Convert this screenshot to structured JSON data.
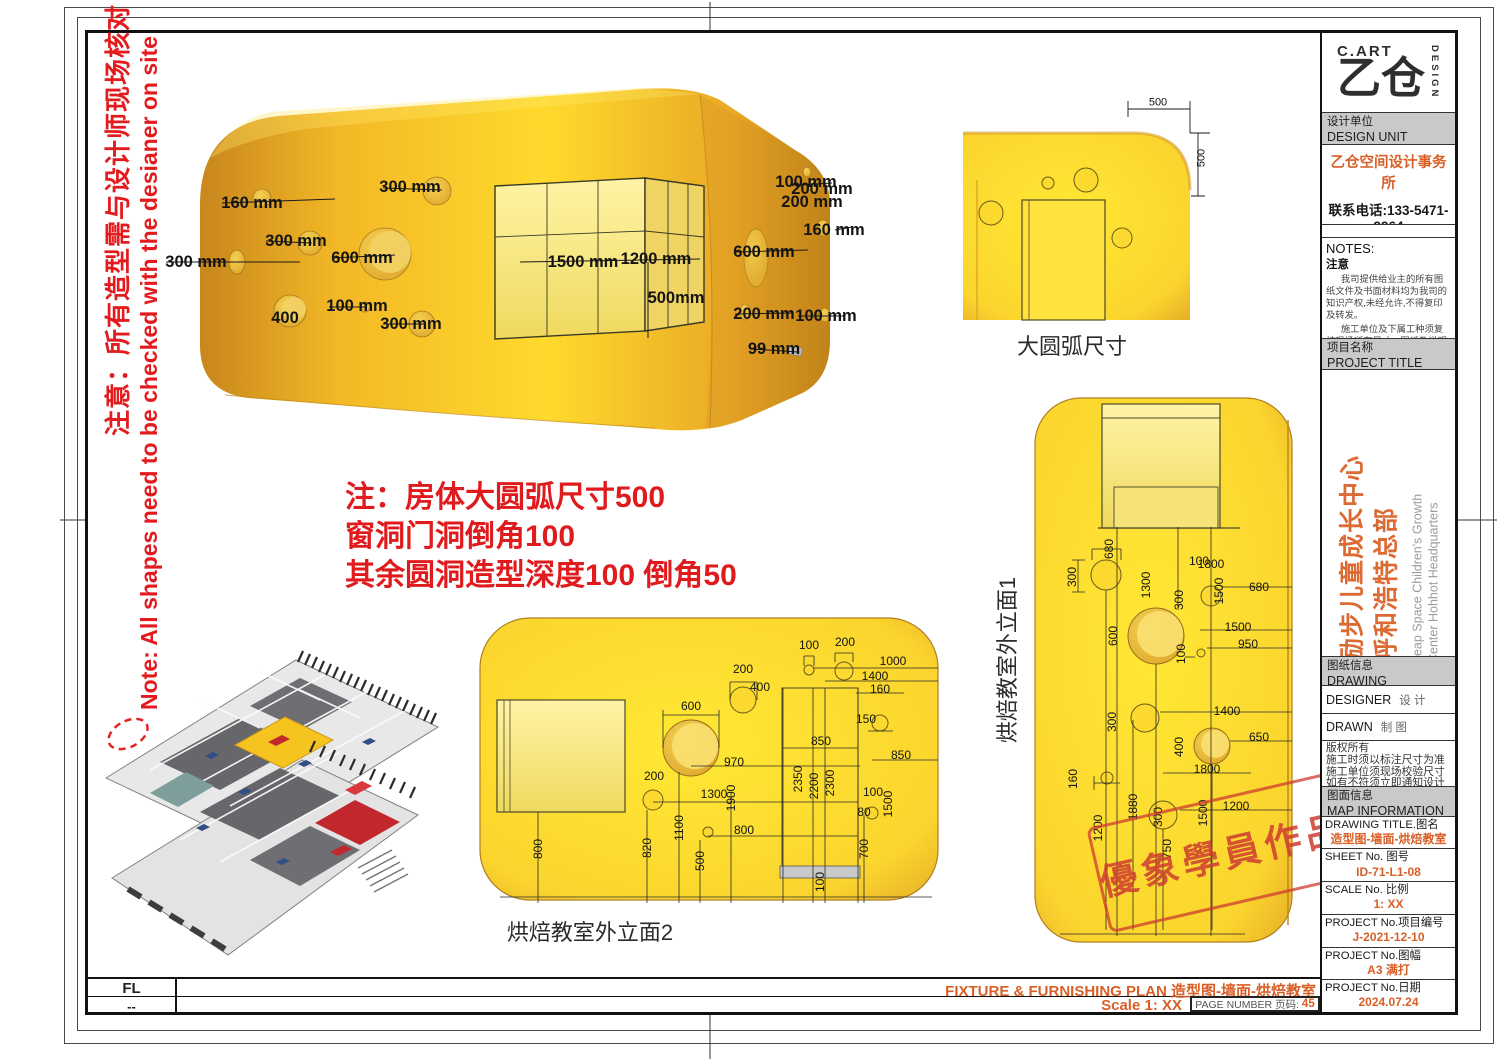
{
  "colors": {
    "accent_orange": "#D95F26",
    "note_red": "#E01B1E",
    "stamp_red": "#CE3C30",
    "panel_yellow": "#FFE02E"
  },
  "left_note": {
    "zh": "注意：所有造型需与设计师现场核对",
    "en": "Note: All shapes need to be checked with the desianer on site"
  },
  "center_note": {
    "line1": "注：房体大圆弧尺寸500",
    "line2": "窗洞门洞倒角100",
    "line3": "其余圆洞造型深度100 倒角50"
  },
  "views": {
    "main3d": {
      "dims": [
        {
          "t": "160 mm",
          "x": 252,
          "y": 203
        },
        {
          "t": "300 mm",
          "x": 410,
          "y": 187
        },
        {
          "t": "300 mm",
          "x": 296,
          "y": 241
        },
        {
          "t": "300 mm",
          "x": 196,
          "y": 262
        },
        {
          "t": "600 mm",
          "x": 362,
          "y": 258
        },
        {
          "t": "400",
          "x": 285,
          "y": 318
        },
        {
          "t": "100 mm",
          "x": 357,
          "y": 306
        },
        {
          "t": "300 mm",
          "x": 411,
          "y": 324
        },
        {
          "t": "1500 mm",
          "x": 583,
          "y": 262
        },
        {
          "t": "1200 mm",
          "x": 656,
          "y": 259
        },
        {
          "t": "500mm",
          "x": 676,
          "y": 298
        },
        {
          "t": "100 mm",
          "x": 806,
          "y": 182
        },
        {
          "t": "200 mm",
          "x": 822,
          "y": 189
        },
        {
          "t": "200 mm",
          "x": 812,
          "y": 202
        },
        {
          "t": "160 mm",
          "x": 834,
          "y": 230
        },
        {
          "t": "600 mm",
          "x": 764,
          "y": 252
        },
        {
          "t": "200 mm",
          "x": 764,
          "y": 314
        },
        {
          "t": "100 mm",
          "x": 826,
          "y": 316
        },
        {
          "t": "99 mm",
          "x": 774,
          "y": 349
        }
      ]
    },
    "corner_detail": {
      "caption": "大圆弧尺寸",
      "dims": [
        {
          "t": "500",
          "x": 1158,
          "y": 103
        },
        {
          "t": "500",
          "x": 1202,
          "y": 158,
          "r": -90
        }
      ]
    },
    "elevation2": {
      "caption": "烘焙教室外立面2",
      "dims": [
        {
          "t": "100",
          "x": 809,
          "y": 645
        },
        {
          "t": "200",
          "x": 845,
          "y": 642
        },
        {
          "t": "1000",
          "x": 893,
          "y": 661
        },
        {
          "t": "1400",
          "x": 875,
          "y": 676
        },
        {
          "t": "160",
          "x": 880,
          "y": 689
        },
        {
          "t": "200",
          "x": 743,
          "y": 669
        },
        {
          "t": "400",
          "x": 760,
          "y": 687
        },
        {
          "t": "600",
          "x": 691,
          "y": 706
        },
        {
          "t": "150",
          "x": 866,
          "y": 719
        },
        {
          "t": "850",
          "x": 821,
          "y": 741
        },
        {
          "t": "850",
          "x": 901,
          "y": 755
        },
        {
          "t": "970",
          "x": 734,
          "y": 762
        },
        {
          "t": "2350",
          "x": 798,
          "y": 779,
          "r": -90
        },
        {
          "t": "2200",
          "x": 814,
          "y": 786,
          "r": -90
        },
        {
          "t": "2300",
          "x": 830,
          "y": 783,
          "r": -90
        },
        {
          "t": "200",
          "x": 654,
          "y": 776
        },
        {
          "t": "1300",
          "x": 714,
          "y": 794
        },
        {
          "t": "1900",
          "x": 731,
          "y": 798,
          "r": -90
        },
        {
          "t": "100",
          "x": 873,
          "y": 792
        },
        {
          "t": "1500",
          "x": 888,
          "y": 804,
          "r": -90
        },
        {
          "t": "80",
          "x": 864,
          "y": 812
        },
        {
          "t": "1100",
          "x": 679,
          "y": 828,
          "r": -90
        },
        {
          "t": "800",
          "x": 744,
          "y": 830
        },
        {
          "t": "800",
          "x": 538,
          "y": 849,
          "r": -90
        },
        {
          "t": "820",
          "x": 647,
          "y": 848,
          "r": -90
        },
        {
          "t": "500",
          "x": 700,
          "y": 861,
          "r": -90
        },
        {
          "t": "700",
          "x": 864,
          "y": 849,
          "r": -90
        },
        {
          "t": "100",
          "x": 820,
          "y": 882,
          "r": -90
        }
      ]
    },
    "elevation1": {
      "caption": "烘焙教室外立面1",
      "dims": [
        {
          "t": "680",
          "x": 1109,
          "y": 549,
          "r": -90
        },
        {
          "t": "300",
          "x": 1072,
          "y": 577,
          "r": -90
        },
        {
          "t": "1300",
          "x": 1146,
          "y": 585,
          "r": -90
        },
        {
          "t": "100",
          "x": 1199,
          "y": 561
        },
        {
          "t": "1800",
          "x": 1211,
          "y": 564
        },
        {
          "t": "1500",
          "x": 1219,
          "y": 591,
          "r": -90
        },
        {
          "t": "680",
          "x": 1259,
          "y": 587
        },
        {
          "t": "300",
          "x": 1179,
          "y": 600,
          "r": -90
        },
        {
          "t": "600",
          "x": 1113,
          "y": 636,
          "r": -90
        },
        {
          "t": "1500",
          "x": 1238,
          "y": 627
        },
        {
          "t": "950",
          "x": 1248,
          "y": 644
        },
        {
          "t": "100",
          "x": 1181,
          "y": 654,
          "r": -90
        },
        {
          "t": "300",
          "x": 1112,
          "y": 722,
          "r": -90
        },
        {
          "t": "1400",
          "x": 1227,
          "y": 711
        },
        {
          "t": "400",
          "x": 1179,
          "y": 747,
          "r": -90
        },
        {
          "t": "650",
          "x": 1259,
          "y": 737
        },
        {
          "t": "1800",
          "x": 1207,
          "y": 769
        },
        {
          "t": "160",
          "x": 1073,
          "y": 779,
          "r": -90
        },
        {
          "t": "1880",
          "x": 1133,
          "y": 807,
          "r": -90
        },
        {
          "t": "300",
          "x": 1158,
          "y": 817,
          "r": -90
        },
        {
          "t": "1200",
          "x": 1236,
          "y": 806
        },
        {
          "t": "1500",
          "x": 1203,
          "y": 813,
          "r": -90
        },
        {
          "t": "1200",
          "x": 1098,
          "y": 828,
          "r": -90
        },
        {
          "t": "750",
          "x": 1167,
          "y": 849,
          "r": -90
        }
      ]
    }
  },
  "stamp": {
    "text": "優象學員作品"
  },
  "titleblock": {
    "logo": {
      "brand": "C.ART",
      "glyph": "乙仓",
      "vertical": "DESIGN"
    },
    "design_unit": {
      "zh": "设计单位",
      "en": "DESIGN UNIT",
      "company": "乙仓空间设计事务所",
      "phone": "联系电话:133-5471-9964",
      "coop_en": "COOPERATIVE DESIGN",
      "coop_zh": "合作设计",
      "coop_value": "XXXXXX"
    },
    "notes": {
      "en": "NOTES:",
      "zh": "注意",
      "p1": "我司提供给业主的所有图纸文件及书面材料均为我司的知识产权,未经允许,不得复印及转发。",
      "p2": "施工单位及下属工种须复核现场所有尺寸、图纸及说明如有出入应及时报告。"
    },
    "project_title": {
      "zh": "项目名称",
      "en": "PROJECT TITLE",
      "title_zh1": "励步儿童成长中心",
      "title_zh2": "呼和浩特总部",
      "title_en1": "Leap Space Children's Growth",
      "title_en2": "Center Hohhot Headquarters"
    },
    "drawing_info": {
      "zh": "图纸信息",
      "en": "DRAWING INFORMATION",
      "designer_label": "DESIGNER",
      "designer_zh": "设 计",
      "drawn_label": "DRAWN",
      "drawn_zh": "制 图",
      "copyright": [
        "版权所有",
        "施工时须以标注尺寸为准",
        "施工单位须现场校验尺寸",
        "如有不符须立即通知设计单位"
      ]
    },
    "map_info": {
      "zh": "图面信息",
      "en": "MAP INFORMATION",
      "rows": [
        {
          "label": "DRAWING TITLE.图名",
          "value": "造型图-墙面-烘焙教室"
        },
        {
          "label": "SHEET No. 图号",
          "value": "ID-71-L1-08"
        },
        {
          "label": "SCALE No. 比例",
          "value": "1: XX"
        },
        {
          "label": "PROJECT No.项目编号",
          "value": "J-2021-12-10"
        },
        {
          "label": "PROJECT No.图幅",
          "value": "A3 满打"
        },
        {
          "label": "PROJECT No.日期",
          "value": "2024.07.24"
        }
      ]
    }
  },
  "footer": {
    "fl": "FL",
    "dash": "--",
    "plan_title": "FIXTURE & FURNISHING PLAN 造型图-墙面-烘焙教室",
    "scale": "Scale 1: XX",
    "page_label": "PAGE NUMBER 页码:",
    "page_number": "45"
  }
}
